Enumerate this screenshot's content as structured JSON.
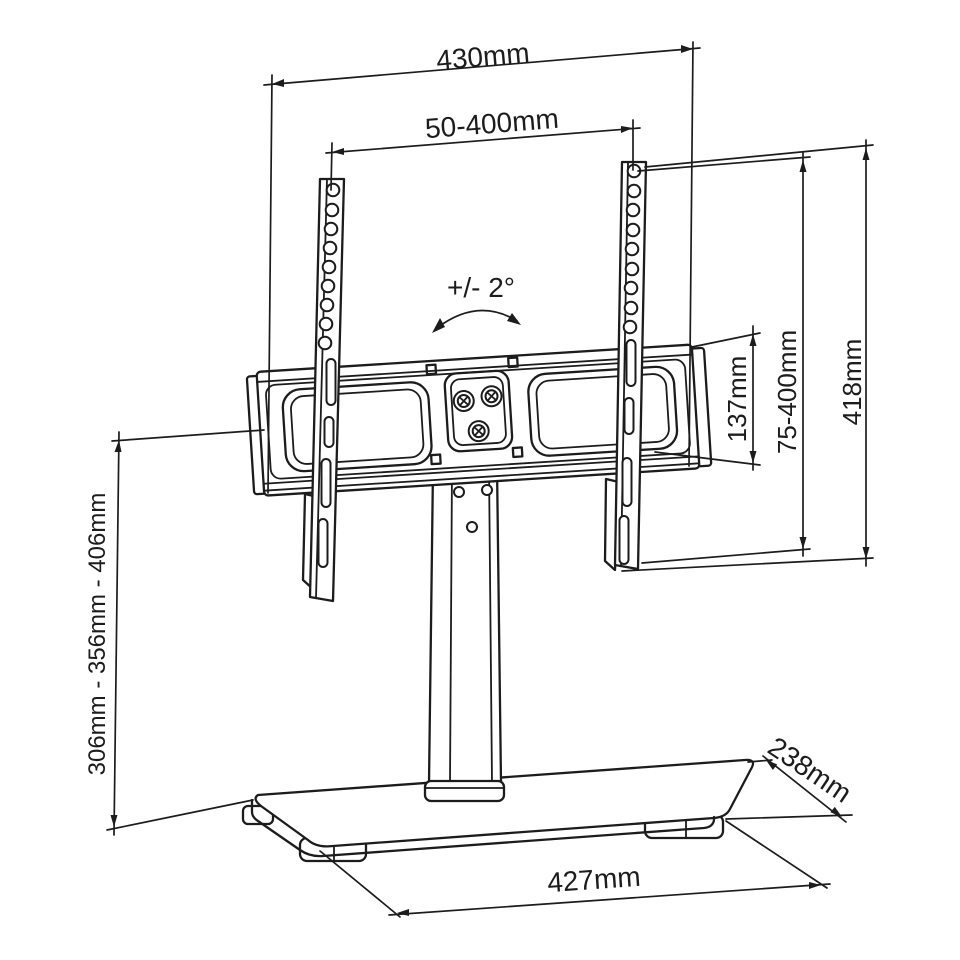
{
  "diagram": {
    "subject": "tabletop-tv-stand-technical-drawing",
    "background_color": "#ffffff",
    "line_color": "#1c1c1c",
    "labels": {
      "bracket_width": "430mm",
      "vesa_width_range": "50-400mm",
      "swivel_angle": "+/- 2°",
      "plate_height": "137mm",
      "vesa_height_range": "75-400mm",
      "bracket_total_height": "418mm",
      "height_adjustment": "306mm - 356mm - 406mm",
      "base_depth": "238mm",
      "base_width": "427mm"
    },
    "icons": {
      "swivel_arrow": "double-headed-curved-arrow"
    }
  }
}
